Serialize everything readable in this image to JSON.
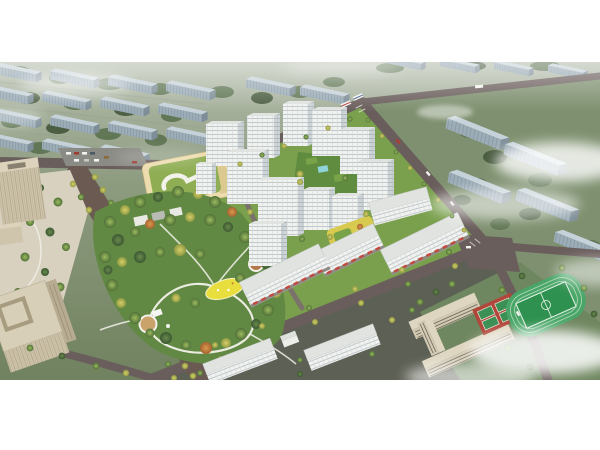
{
  "image": {
    "type": "aerial-architectural-rendering",
    "has_visible_text": false,
    "description": "Bird's-eye masterplan rendering of a residential development: a cluster of white high-rise apartment towers with a green central courtyard, long retail-base slabs along the south-east edge, a large landscaped park with winding white paths and a yellow playground, a kindergarten with a green roof and white loop, a tree-lined boulevard, beige office towers on the left, low slab housing below, a school campus with red basketball courts and a green sports field at the lower right, and rows of hazy blue-grey housing blocks fading into mist in the background."
  },
  "palette": {
    "pageBg": "#ffffff",
    "hazeTop": "#b3bcab",
    "ground": "#8d9b7f",
    "groundRight": "#7e906f",
    "asphalt": "#5d6054",
    "siteGreen": "#7aa04d",
    "parkGreen": "#628943",
    "plaza": "#d8d1c0",
    "parking": "#8b8b85",
    "road": "#6a5e5c",
    "roadMinor": "#7b726b",
    "boulevard": "#6a5a52",
    "pathWhite": "#f2f1ea",
    "towerFace": "#f1f3f1",
    "towerRoof": "#e0e3df",
    "towerShade": "#ccd4d7",
    "slabTop": "#c6d2d9",
    "slabFace": "#9cadb8",
    "slabSide": "#7e8e98",
    "kindergartenRoof": "#8fae54",
    "kindergartenWall": "#ecdcae",
    "officeBeige": "#cfc5ac",
    "officeShade": "#b7ac92",
    "schoolBeige": "#d2c9b3",
    "schoolRoof": "#ded6c0",
    "fieldGreen": "#4aa668",
    "pitchGreen": "#2f9150",
    "courtRed": "#b0473a",
    "courtGreen": "#3c8f55",
    "awningRed": "#c2493f",
    "playgroundYellow": "#e8df3e",
    "poolBlue": "#8fd4d8",
    "podiumYellow": "#d8c94f",
    "treeGreen": "#6f9a4a",
    "treeYellow": "#c2c05a",
    "treeDark": "#466243",
    "backgroundTree": "#5c7350",
    "mist": "#ffffff"
  },
  "scene": {
    "background": [
      "hazy rows of slab apartment blocks",
      "muted trees",
      "clouds and mist"
    ],
    "site_elements": [
      "residential towers",
      "retail-base slabs",
      "central park",
      "kindergarten",
      "parking lot",
      "courtyard garden",
      "roof podium garden",
      "boulevard"
    ],
    "surroundings": [
      "office towers",
      "office plaza",
      "low housing slabs",
      "school campus",
      "basketball courts",
      "sports field",
      "road network",
      "street trees",
      "vehicles"
    ]
  }
}
